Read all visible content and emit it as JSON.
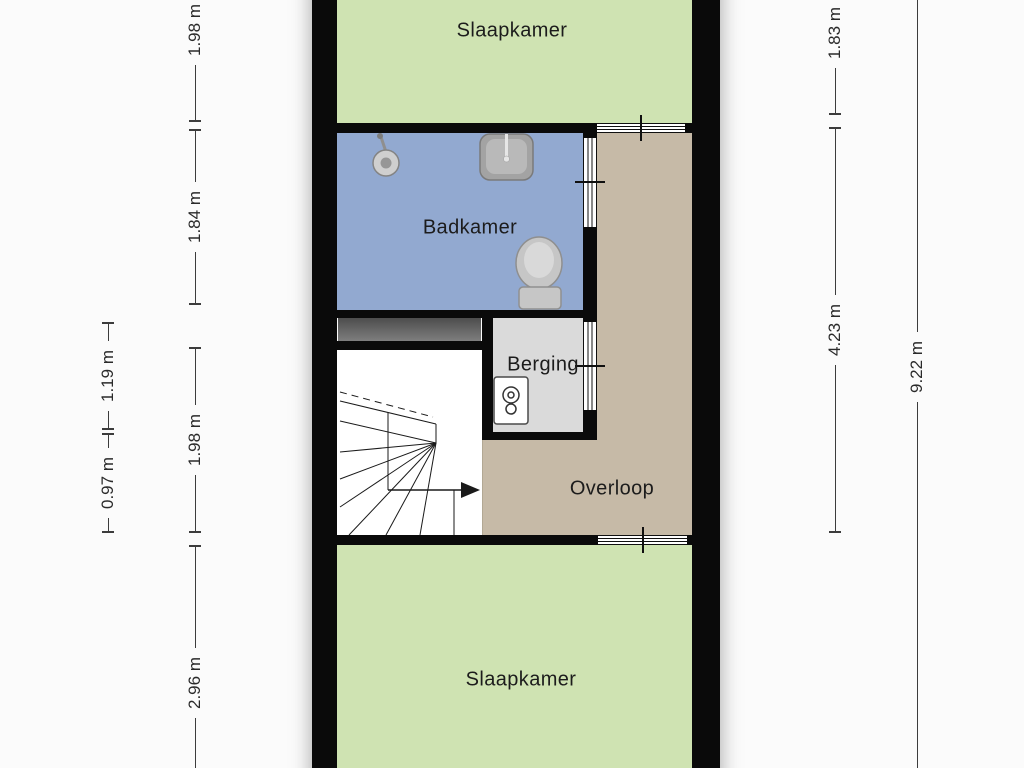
{
  "plan": {
    "type": "floorplan",
    "rooms": [
      {
        "id": "slaapkamer-top",
        "label": "Slaapkamer",
        "color": "#cfe3b2"
      },
      {
        "id": "badkamer",
        "label": "Badkamer",
        "color": "#92a9d0"
      },
      {
        "id": "berging",
        "label": "Berging",
        "color": "#dadada"
      },
      {
        "id": "overloop",
        "label": "Overloop",
        "color": "#c6baa7"
      },
      {
        "id": "slaapkamer-bottom",
        "label": "Slaapkamer",
        "color": "#cfe3b2"
      }
    ],
    "fixtures": [
      {
        "icon": "shower-icon",
        "room": "badkamer"
      },
      {
        "icon": "sink-icon",
        "room": "badkamer"
      },
      {
        "icon": "toilet-icon",
        "room": "badkamer"
      },
      {
        "icon": "boiler-icon",
        "room": "berging"
      },
      {
        "icon": "staircase",
        "room": "overloop"
      }
    ],
    "dimensions": {
      "left_inner": [
        {
          "label": "1.98 m"
        },
        {
          "label": "1.84 m"
        },
        {
          "label": "1.98 m"
        },
        {
          "label": "2.96 m"
        }
      ],
      "left_outer": [
        {
          "label": "1.19 m"
        },
        {
          "label": "0.97 m"
        }
      ],
      "right_inner": [
        {
          "label": "1.83 m"
        },
        {
          "label": "4.23 m"
        }
      ],
      "right_outer": [
        {
          "label": "9.22 m"
        }
      ]
    },
    "colors": {
      "wall": "#0a0a0a",
      "background": "#fbfbfb",
      "bedroom_green": "#cfe3b2",
      "bathroom_blue": "#92a9d0",
      "landing_tan": "#c6baa7",
      "storage_gray": "#dadada",
      "half_wall_gray": "#5c5c5c",
      "dimension_line": "#3c3c3c"
    }
  }
}
